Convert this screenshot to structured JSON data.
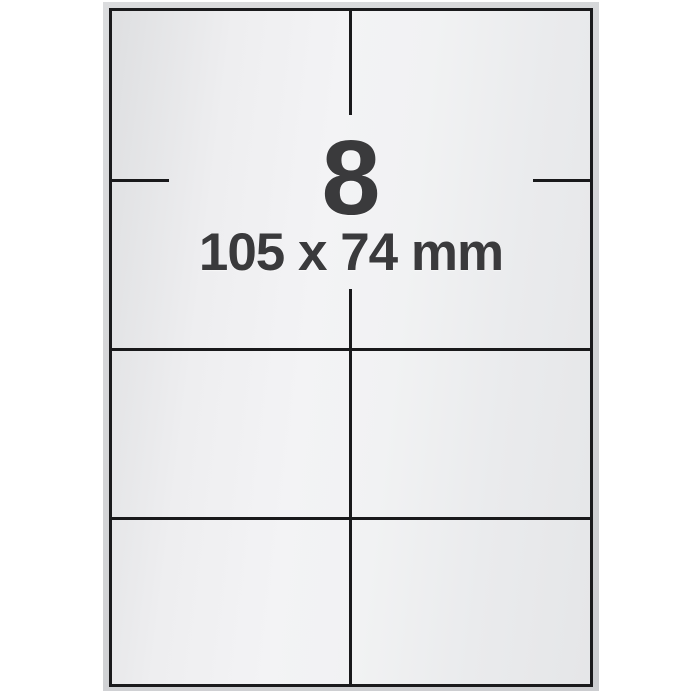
{
  "sheet_diagram": {
    "label_count": "8",
    "label_dimensions": "105 x 74 mm",
    "grid": {
      "rows": 4,
      "columns": 2,
      "labels_total": 8
    }
  },
  "colors": {
    "page_background": "#ffffff",
    "paper_edge": "#d4d5d7",
    "sheet_border": "#1a1a1c",
    "divider_line": "#19191b",
    "text": "#3a3a3c",
    "paper_face_light": "#f3f3f5",
    "paper_face_dark": "#dedfe1"
  }
}
